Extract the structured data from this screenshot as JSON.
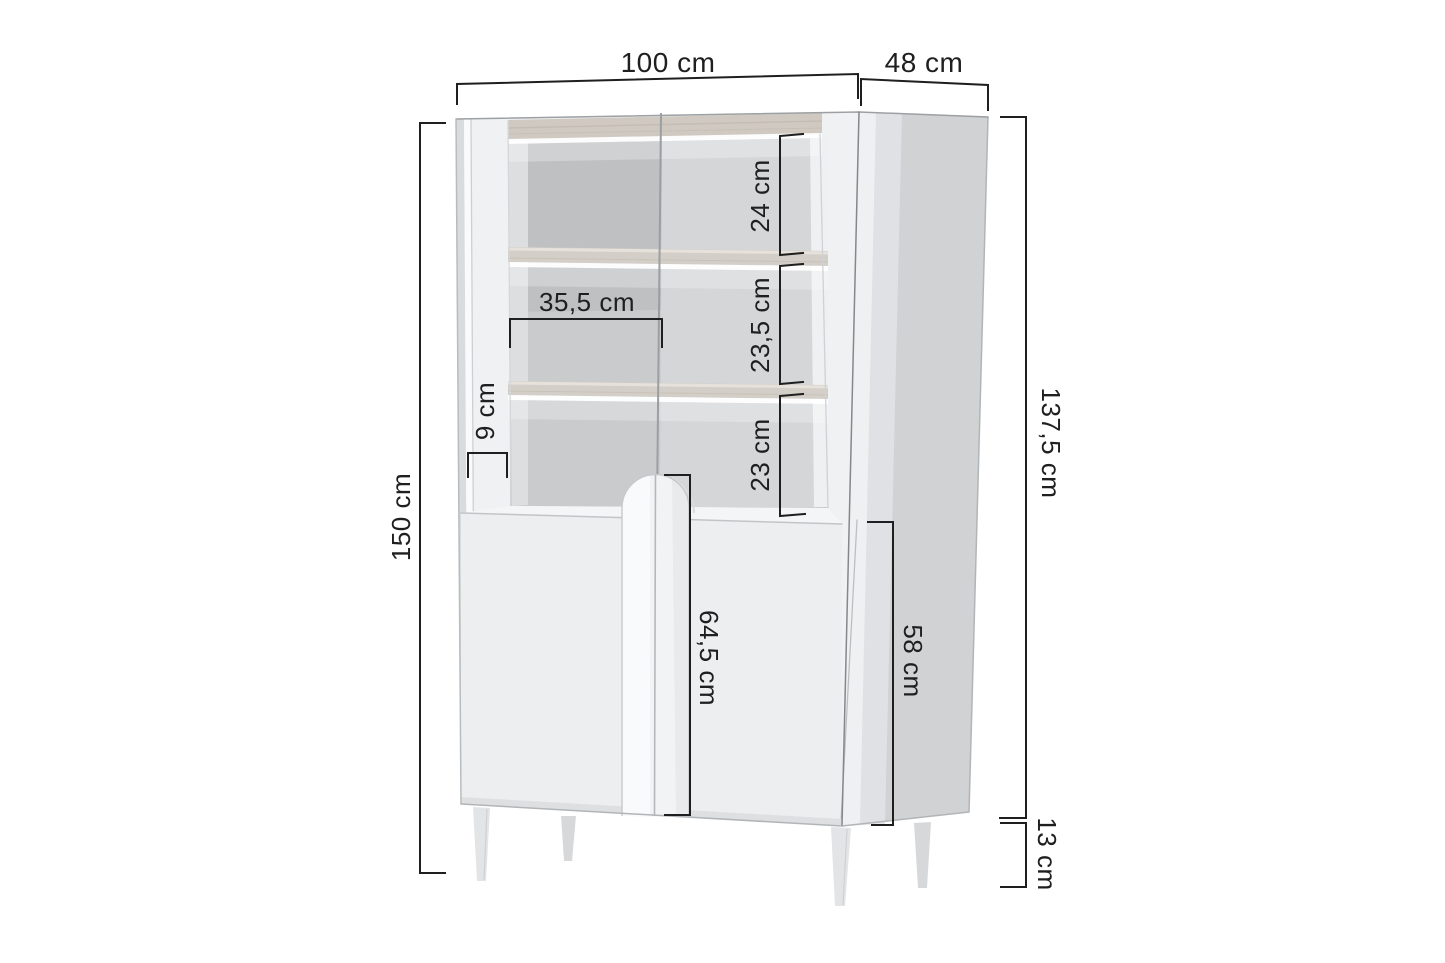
{
  "diagram": {
    "type": "furniture-dimension-diagram",
    "product": "display cabinet with open backlit shelves, two doors and legs",
    "unit": "cm",
    "dimensions": {
      "width": "100 cm",
      "depth": "48 cm",
      "height": "150 cm",
      "body_height": "137,5 cm",
      "legs_height": "13 cm",
      "top_shelf_space": "24 cm",
      "middle_shelf_space": "23,5 cm",
      "bottom_shelf_space": "23 cm",
      "inner_shelf_width": "35,5 cm",
      "side_stile_width": "9 cm",
      "door_height": "64,5 cm",
      "base_section_height": "58 cm"
    },
    "colors": {
      "background": "#ffffff",
      "dimension_lines": "#1f1f1f",
      "cabinet_front": "#f0f1f3",
      "cabinet_side": "#d0d2d4",
      "interior_back": "#c9cbcd",
      "shelf_wood": "#d3cec7",
      "led_glow": "#ffffff"
    }
  }
}
